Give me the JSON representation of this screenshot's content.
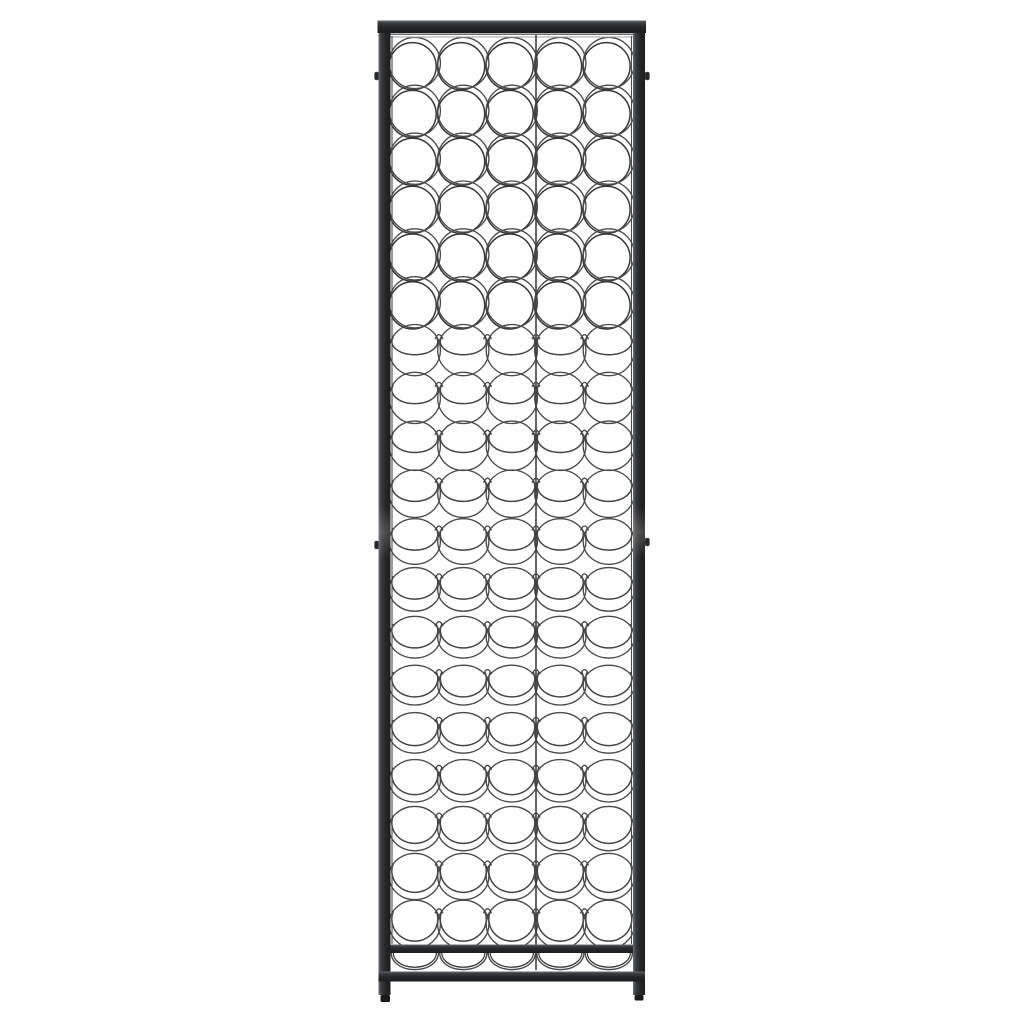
{
  "scene": {
    "description": "Front view product photo of a tall black wrought-iron wall-mounted wine rack with round wire bottle holders",
    "background_color": "#ffffff",
    "canvas": {
      "width": 1024,
      "height": 1024
    }
  },
  "rack": {
    "columns": 5,
    "ring_rows": 19,
    "bottom_cradles": 5,
    "colors": {
      "frame_light": "#6b6f73",
      "frame_mid": "#3a3d40",
      "frame_dark": "#242628",
      "frame_darkest": "#1b1d1f",
      "wire": "#4b4b4b",
      "wire_shadow": "#383838",
      "hammock_wire": "#454545",
      "rail_light": "#a0a3a6",
      "rail_dark": "#5b5e61",
      "foot": "#1a1a1a",
      "background": "#ffffff"
    },
    "grid": {
      "inner_left": 390.5,
      "inner_right": 633,
      "col_pitch": 48.5,
      "row_pitch": 47.85,
      "first_row_center_y": 63,
      "ring_radius": 25.6,
      "back_ring_radius": 23.6,
      "back_ring_offset_x": -2.2,
      "back_ring_offset_y": 3.2,
      "flatten_center_y": 700,
      "flatten_span": 300,
      "flatten_amount": 6,
      "hammock_start_row": 6,
      "hammock_end_height": 13,
      "hammock_ry_min": 13,
      "hammock_ry_max": 22,
      "cusp_half_width": 4,
      "cusp_base_drop": 11,
      "cusp_tip_rise": 20
    },
    "cradles": {
      "anchor_y": 949,
      "half_span": 22.5,
      "rx_outer": 23.5,
      "ry_outer": 16,
      "half_span_inner": 20.5,
      "rx_inner": 21.5,
      "ry_inner": 14
    },
    "frame": {
      "cap": {
        "x": 377.5,
        "y": 20.5,
        "w": 268.5,
        "h": 12.5
      },
      "post_left_x": 378.5,
      "post_right_x": 633,
      "post_width": 12,
      "post_top": 32,
      "post_bottom": 995,
      "shelf_bar": {
        "x": 390.5,
        "y": 944.5,
        "w": 242.5,
        "h": 8.5
      },
      "bottom_bar": {
        "x": 378.5,
        "y": 971.5,
        "w": 266.5,
        "h": 10
      },
      "feet": [
        {
          "x": 380.5,
          "y": 995,
          "w": 9.5,
          "h": 7
        },
        {
          "x": 634.5,
          "y": 995,
          "w": 9,
          "h": 5.5
        }
      ],
      "wall_tabs": [
        {
          "side": "left",
          "x": 374.5,
          "y": 72
        },
        {
          "side": "right",
          "x": 645,
          "y": 72
        },
        {
          "side": "left",
          "x": 374.5,
          "y": 541
        },
        {
          "side": "right",
          "x": 645,
          "y": 538
        }
      ],
      "tab_w": 4.5,
      "tab_h": 8,
      "sleeves": [
        {
          "y": 506,
          "h": 52
        }
      ],
      "rail_y_dark": 34.2,
      "rail_y_light": 37,
      "divider_x": 536,
      "divider_top": 35,
      "divider_bottom": 970,
      "side_wire_xs": [
        392,
        631.5
      ],
      "side_wire_top": 36,
      "side_wire_bottom": 944
    }
  }
}
